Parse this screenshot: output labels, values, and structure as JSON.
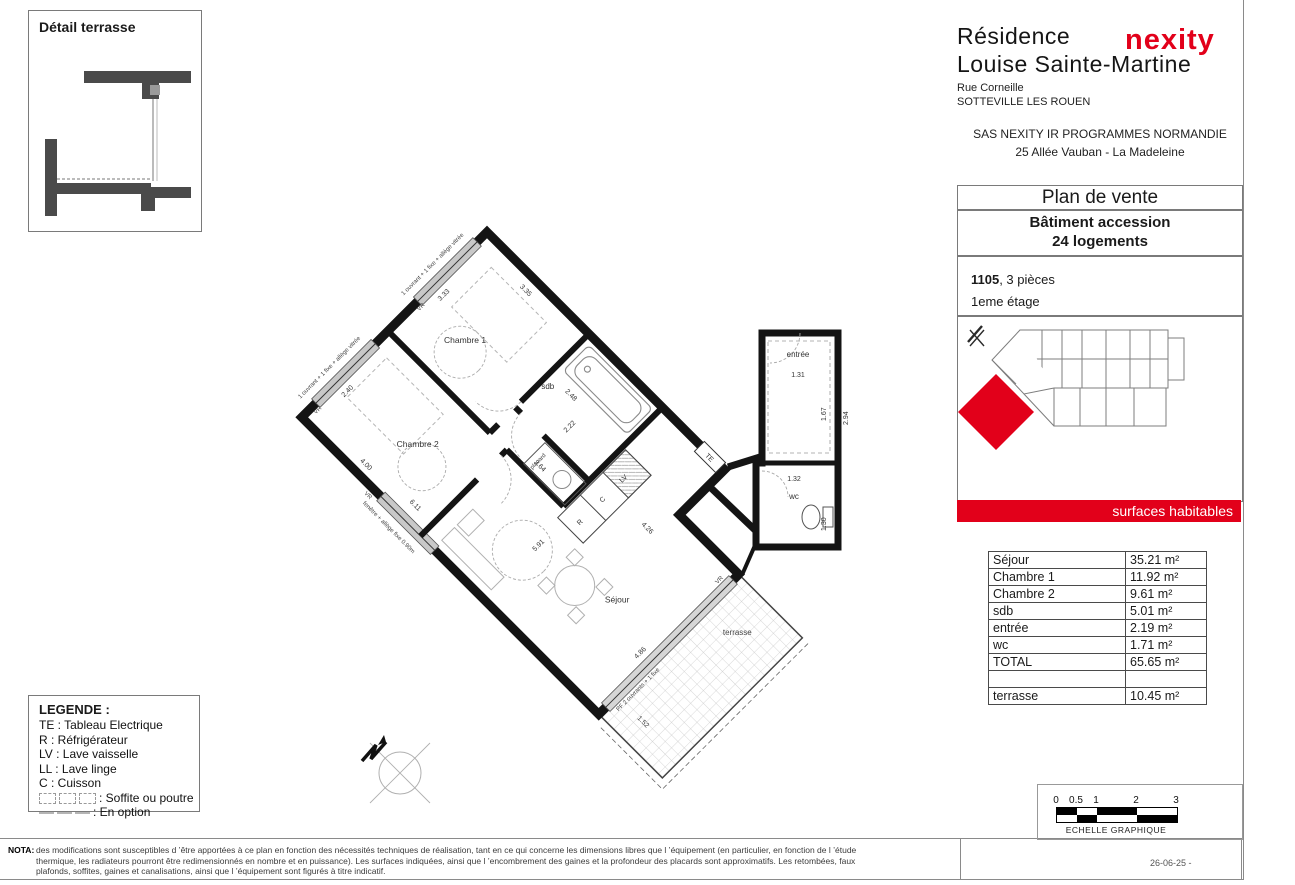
{
  "header": {
    "brand": "nexity",
    "brand_color": "#e2001a",
    "residence_line1": "Résidence",
    "residence_line2": "Louise Sainte-Martine",
    "street": "Rue Corneille",
    "city": "SOTTEVILLE LES ROUEN",
    "company": "SAS NEXITY IR PROGRAMMES NORMANDIE",
    "company_address": "25 Allée Vauban - La Madeleine"
  },
  "detail_box": {
    "title": "Détail terrasse"
  },
  "sale_panel": {
    "title": "Plan de vente",
    "building_line1": "Bâtiment accession",
    "building_line2": "24 logements",
    "unit_number": "1105",
    "unit_suffix": ", 3 pièces",
    "floor": "1eme étage",
    "surfaces_title": "surfaces habitables",
    "surfaces": {
      "rows": [
        {
          "label": "Séjour",
          "value": "35.21 m²"
        },
        {
          "label": "Chambre 1",
          "value": "11.92 m²"
        },
        {
          "label": "Chambre 2",
          "value": "9.61 m²"
        },
        {
          "label": "sdb",
          "value": "5.01 m²"
        },
        {
          "label": "entrée",
          "value": "2.19 m²"
        },
        {
          "label": "wc",
          "value": "1.71 m²"
        },
        {
          "label": "TOTAL",
          "value": "65.65 m²"
        },
        {
          "label": "",
          "value": ""
        },
        {
          "label": "terrasse",
          "value": "10.45 m²"
        }
      ]
    }
  },
  "legend": {
    "title": "LEGENDE :",
    "items": [
      "TE : Tableau Electrique",
      "R : Réfrigérateur",
      "LV : Lave vaisselle",
      "LL : Lave linge",
      "C : Cuisson"
    ],
    "soffite_label": ": Soffite ou poutre",
    "option_label": ": En option"
  },
  "nota": {
    "label": "NOTA:",
    "line1": "des modifications sont susceptibles d ’être apportées à ce plan en fonction des nécessités techniques de réalisation, tant en ce qui concerne les dimensions libres que l ’équipement (en particulier, en fonction de l ’étude",
    "line2": "thermique, les radiateurs pourront être redimensionnés en nombre et en puissance). Les surfaces indiquées, ainsi que l ’encombrement des gaines et la profondeur des placards sont approximatifs. Les retombées, faux",
    "line3": "plafonds, soffites, gaines et canalisations, ainsi que l ’équipement sont figurés à titre indicatif."
  },
  "scale_bar": {
    "ticks": [
      "0",
      "0.5",
      "1",
      "2",
      "3"
    ],
    "label": "ECHELLE GRAPHIQUE"
  },
  "footer": {
    "date": "26-06-25 -"
  },
  "plan": {
    "rooms": {
      "chambre1": {
        "label": "Chambre 1",
        "dim_v": "3.33",
        "dim_h": "3.35"
      },
      "chambre2": {
        "label": "Chambre 2",
        "dim_v": "2.40",
        "dim_h": "4.00"
      },
      "sdb": {
        "label": "sdb",
        "dim_a": "2.48",
        "dim_b": "2.22"
      },
      "sejour": {
        "label": "Séjour",
        "dim1": "6.11",
        "dim2": "5.91",
        "dim3": "4.26",
        "dim4": "3.64"
      },
      "entree": {
        "label": "entrée",
        "dim_h": "1.31",
        "dim_v": "1.67",
        "dim_v2": "2.94"
      },
      "wc": {
        "label": "wc",
        "dim_h": "1.32",
        "dim_v": "1.30"
      },
      "terrasse": {
        "label": "terrasse",
        "dim_len": "4.86",
        "dim_w": "1.52"
      }
    },
    "annotations": {
      "window_ch1": "1 ouvrant + 1 fixe + allège vitrée",
      "window_ch2": "1 ouvrant + 1 fixe + allège vitrée",
      "window_sejour": "fenêtre + allège fixe 0.90m",
      "window_terrasse": "PF 2 ouvrants + 1 fixe",
      "vr": "VR",
      "te": "TE",
      "lv": "LV",
      "c": "C",
      "r": "R",
      "placard": "placard"
    }
  }
}
